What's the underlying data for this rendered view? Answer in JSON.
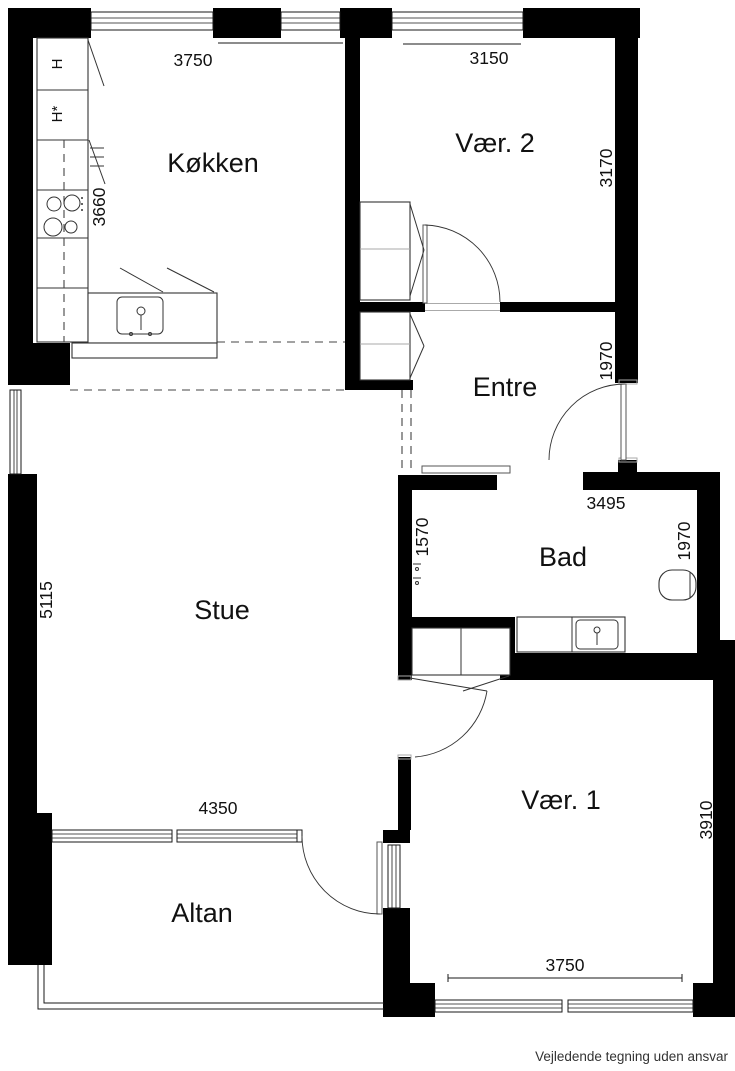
{
  "floorplan": {
    "rooms": {
      "kitchen": {
        "label": "Køkken"
      },
      "room2": {
        "label": "Vær. 2"
      },
      "entre": {
        "label": "Entre"
      },
      "bath": {
        "label": "Bad"
      },
      "living": {
        "label": "Stue"
      },
      "room1": {
        "label": "Vær. 1"
      },
      "balcony": {
        "label": "Altan"
      }
    },
    "dimensions_mm": {
      "kitchen_top": "3750",
      "kitchen_left": "3660",
      "room2_top": "3150",
      "room2_right": "3170",
      "entre_right": "1970",
      "bath_top": "3495",
      "bath_left": "1570",
      "bath_right": "1970",
      "living_left": "5115",
      "living_bottom": "4350",
      "room1_right": "3910",
      "room1_bottom": "3750"
    },
    "appliance_labels": {
      "h": "H",
      "h_star": "H*"
    },
    "colors": {
      "wall": "#000000",
      "background": "#ffffff"
    }
  },
  "footer": {
    "disclaimer": "Vejledende tegning uden ansvar"
  }
}
